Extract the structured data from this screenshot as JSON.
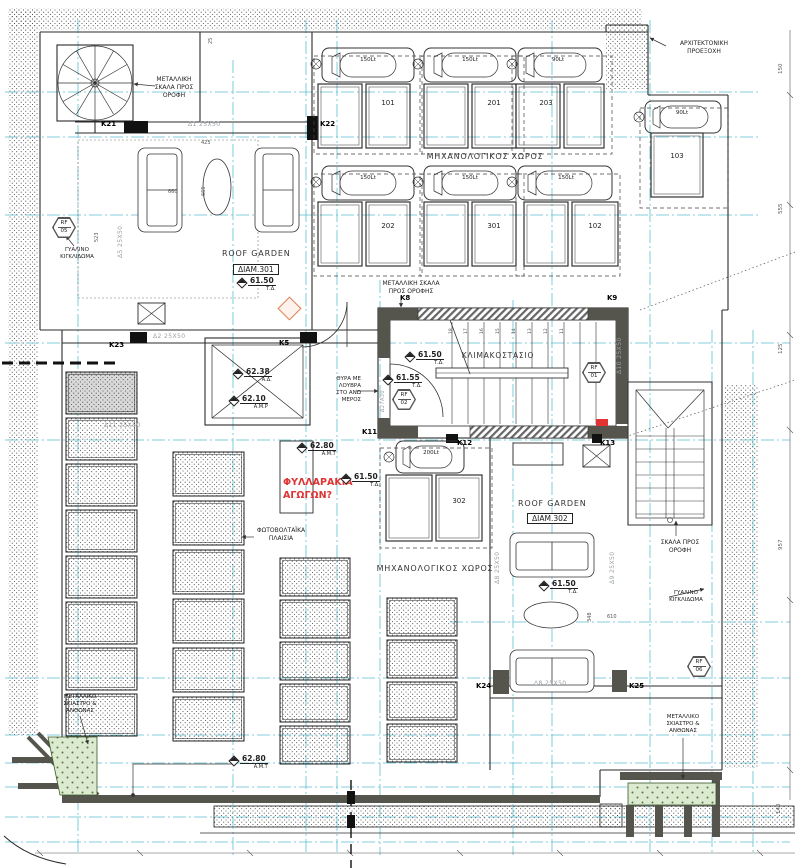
{
  "labels": {
    "metal_stair_top": "ΜΕΤΑΛΛΙΚΗ\nΣΚΑΛΑ ΠΡΟΣ\nΟΡΟΦΗ",
    "metal_stair_mid": "ΜΕΤΑΛΛΙΚΗ ΣΚΑΛΑ\nΠΡΟΣ ΟΡΟΦΗΣ",
    "arch_projection": "ΑΡΧΙΤΕΚΤΟΝΙΚΗ\nΠΡΟΕΞΟΧΗ",
    "mech_top": "ΜΗΧΑΝΟΛΟΓΙΚΟΣ ΧΩΡΟΣ",
    "mech_bottom": "ΜΗΧΑΝΟΛΟΓΙΚΟΣ ΧΩΡΟΣ",
    "stairwell": "ΚΛΙΜΑΚΟΣΤΑΣΙΟ",
    "roof_garden_301": "ROOF GARDEN",
    "apt_301": "ΔΙΑΜ.301",
    "roof_garden_302": "ROOF GARDEN",
    "apt_302": "ΔΙΑΜ.302",
    "door_louvers": "ΘΥΡΑ ΜΕ\nΛΟΥΒΡΑ\nΣΤΟ ΑΝΩ\nΜΕΡΟΣ",
    "pv_panels": "ΦΩΤΟΒΟΛΤΑΪΚΑ\nΠΛΑΙΣΙΑ",
    "red_note": "ΦΥΛΛΑΡΑΚΙΑ\nΑΓΩΓΩΝ?",
    "glass_rail_left": "ΓΥΑΛΙΝΟ\nΚΙΓΚΛΙΔΩΜΑ",
    "glass_rail_right": "ΓΥΑΛΙΝΟ\nΚΙΓΚΛΙΔΩΜΑ",
    "stair_to_roof_right": "ΣΚΑΛΑ ΠΡΟΣ\nΟΡΟΦΗ",
    "shade_left": "ΜΕΤΑΛΛΙΚΟ\nΣΚΙΑΣΤΡΟ &\nΑΝΘΩΝΑΣ",
    "shade_right": "ΜΕΤΑΛΛΙΚΟ\nΣΚΙΑΣΤΡΟ &\nΑΝΘΩΝΑΣ"
  },
  "columns": {
    "k21": "K21",
    "k22": "K22",
    "k23": "K23",
    "k5": "K5",
    "k8": "K8",
    "k9": "K9",
    "k11": "K11",
    "k12": "K12",
    "k13": "K13",
    "k24": "K24",
    "k25": "K25"
  },
  "beams": {
    "d1": "Δ1  25X50",
    "d2": "Δ2  25X50",
    "d5": "Δ5  25X50",
    "d8": "Δ8  25X50",
    "d8b": "Δ8  25X50",
    "d9": "Δ9  25X50",
    "d10": "Δ10  25X50",
    "d11": "Δ11  25X50",
    "d27": "Δ27Α30"
  },
  "units": [
    {
      "tank": "150Lt",
      "panel": "101"
    },
    {
      "tank": "150Lt",
      "panel": "201"
    },
    {
      "tank": "90Lt",
      "panel": "203"
    },
    {
      "tank": "90Lt",
      "panel": "103"
    },
    {
      "tank": "150Lt",
      "panel": "202"
    },
    {
      "tank": "150Lt",
      "panel": "301"
    },
    {
      "tank": "150Lt",
      "panel": "102"
    },
    {
      "tank": "200Lt",
      "panel": "302"
    }
  ],
  "elevations": [
    {
      "v": "61.50",
      "r": "Τ.Δ."
    },
    {
      "v": "62.38",
      "r": "Α.Δ."
    },
    {
      "v": "62.10",
      "r": "Α.Μ.Ρ"
    },
    {
      "v": "62.80",
      "r": "Α.Μ.Τ"
    },
    {
      "v": "61.50",
      "r": "Τ.Δ."
    },
    {
      "v": "61.55",
      "r": "Τ.Δ."
    },
    {
      "v": "61.50",
      "r": "Τ.Δ."
    },
    {
      "v": "61.50",
      "r": "Τ.Δ."
    },
    {
      "v": "62.80",
      "r": "Α.Μ.Τ"
    }
  ],
  "rf_markers": [
    {
      "a": "RF",
      "b": "05"
    },
    {
      "a": "RF",
      "b": "02"
    },
    {
      "a": "RF",
      "b": "01"
    },
    {
      "a": "RF",
      "b": "06"
    }
  ],
  "dims": {
    "d425": "425",
    "d660": "660",
    "d665": "665",
    "d523": "523",
    "d25": "25",
    "d150": "150",
    "d555": "555",
    "d125": "125",
    "d957": "957",
    "d140": "140",
    "d348": "348",
    "d610": "610"
  },
  "treads": [
    "18",
    "17",
    "16",
    "15",
    "14",
    "13",
    "12",
    "11"
  ],
  "colors": {
    "centerline": "#3fb4c9",
    "red_note": "#e03333",
    "planter_green": "#dcead0",
    "wall": "#56554d",
    "beam_text": "#9aa0a6",
    "orange_marker": "#e08050"
  }
}
